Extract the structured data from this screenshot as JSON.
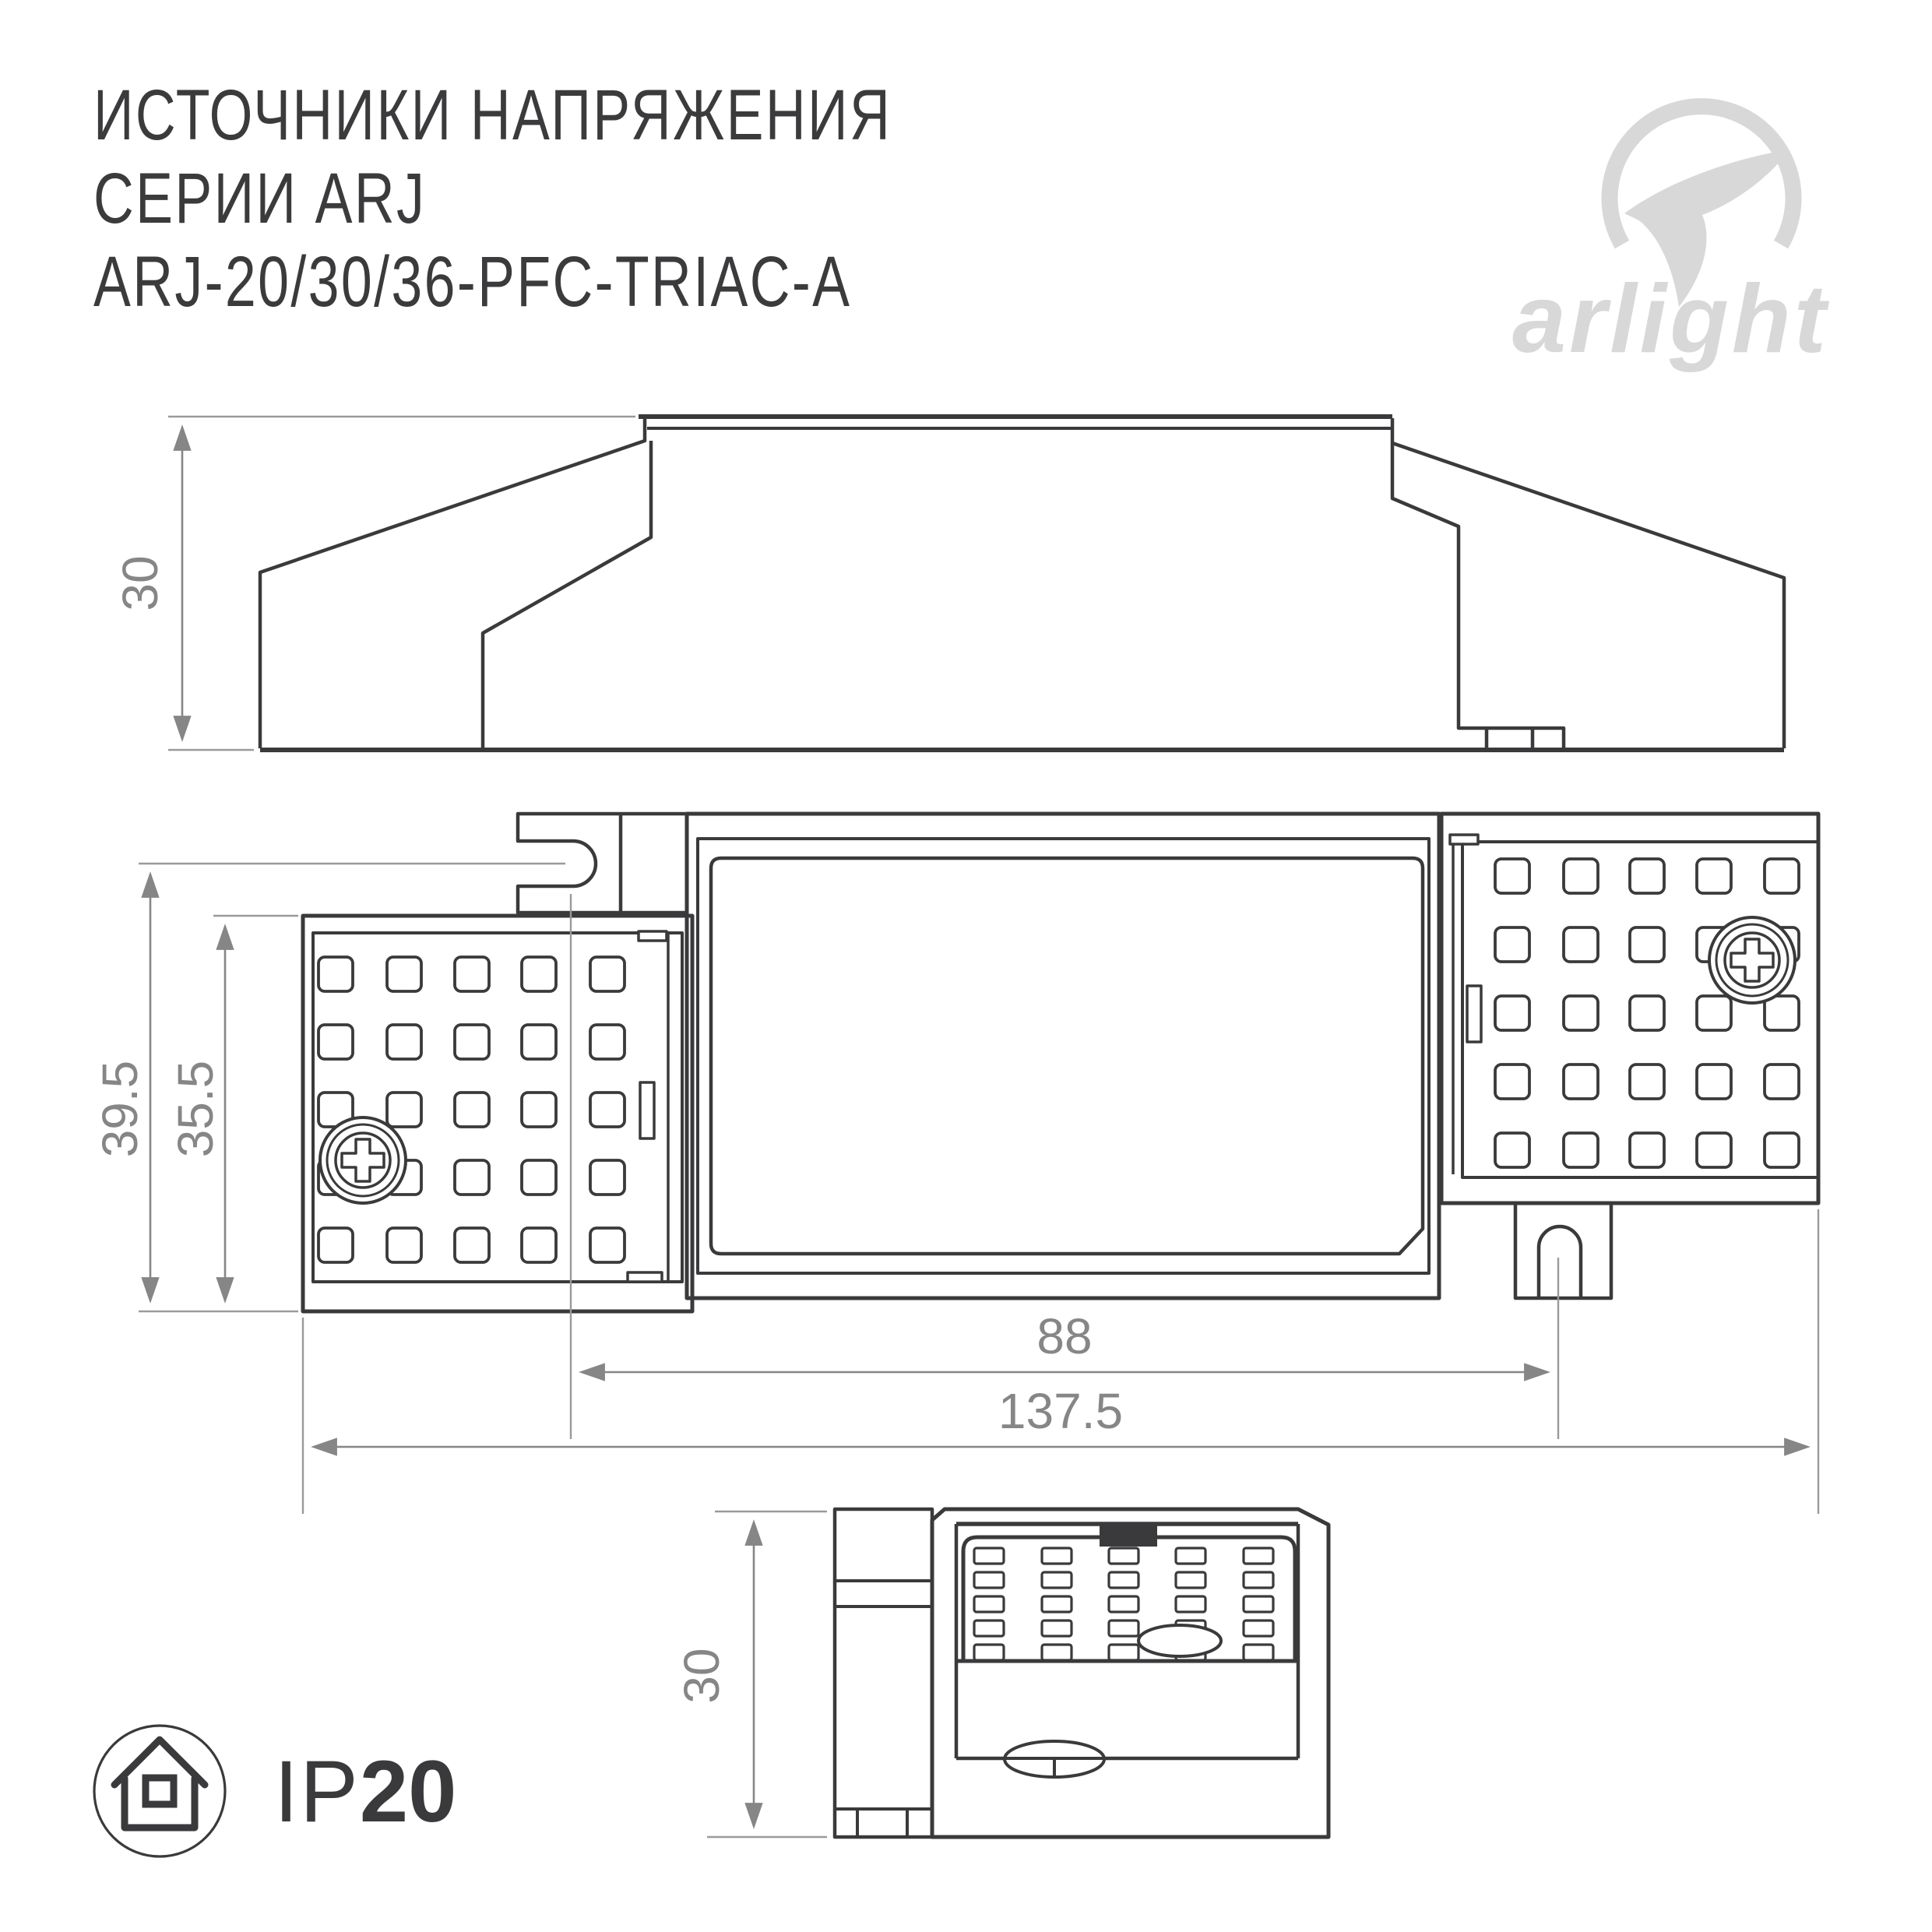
{
  "header": {
    "title_line1": "ИСТОЧНИКИ НАПРЯЖЕНИЯ",
    "title_line2": "СЕРИИ ARJ",
    "title_line3": "ARJ-20/30/36-PFC-TRIAC-A"
  },
  "logo": {
    "wordmark": "arlight",
    "color": "#d8d8d8"
  },
  "drawing": {
    "line_color": "#3a3a3c",
    "dimension_color": "#868686",
    "dims": {
      "side_height": "30",
      "top_width_overall": "39.5",
      "top_width_body": "35.5",
      "hole_spacing": "88",
      "length_overall": "137.5",
      "end_height": "30"
    }
  },
  "ip_badge": {
    "prefix": "IP",
    "value": "20"
  }
}
